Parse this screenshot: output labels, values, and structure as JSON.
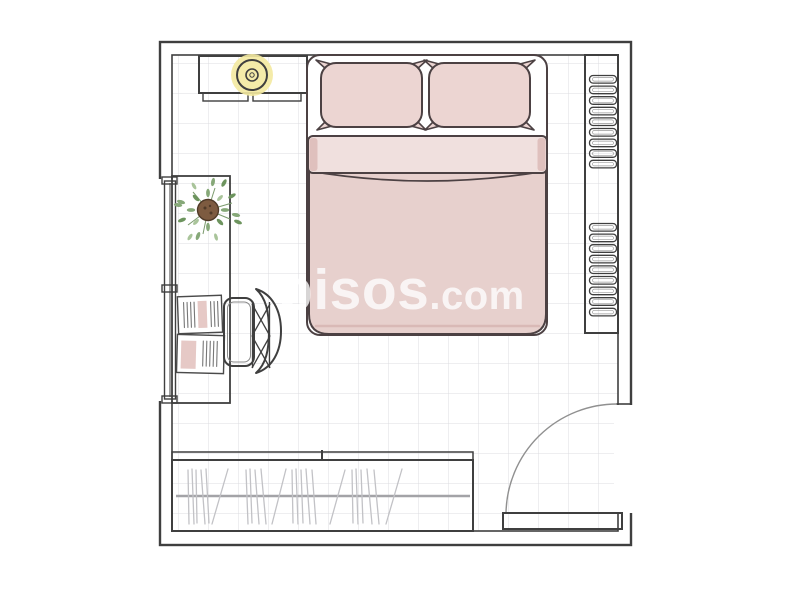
{
  "watermark": {
    "brand": "pisos",
    "tld": ".com"
  },
  "room": {
    "label": "bedroom floor plan",
    "furniture": [
      "double-bed",
      "pillow-left",
      "pillow-right",
      "duvet",
      "sheet-fold",
      "nightstand",
      "table-lamp",
      "shelf-unit",
      "window",
      "desk",
      "potted-plant",
      "notebook",
      "office-chair",
      "wardrobe",
      "clothes-rail",
      "hanging-clothes",
      "sliding-door-track",
      "door",
      "door-swing-arc",
      "tiled-floor"
    ]
  },
  "colors": {
    "wall_line": "#3f3f3f",
    "bed_line": "#4c4143",
    "floor_grid": "#dcdce0",
    "duvet_pink": "#e7d0cd",
    "sheet_pink": "#f0e0de",
    "pillow_pink": "#ecd5d2",
    "fold_pink": "#dfc0bd",
    "duvet_shade_pink": "#d9b9b6",
    "lamp_glow_yellow": "#f3e9a0",
    "lamp_ring_yellow": "#efe08e",
    "plant_green": "#86a878",
    "plant_green_dark": "#6d945e",
    "plant_green_light": "#a9c49a",
    "stem_green": "#7b9a6d",
    "pot_brown": "#7d5b40",
    "pot_brown_dark": "#4f3a28",
    "clothes_line_gray": "#c2c2c6",
    "rail_gray": "#a3a3a7",
    "arc_gray": "#909090",
    "watermark_white": "#ffffff"
  }
}
